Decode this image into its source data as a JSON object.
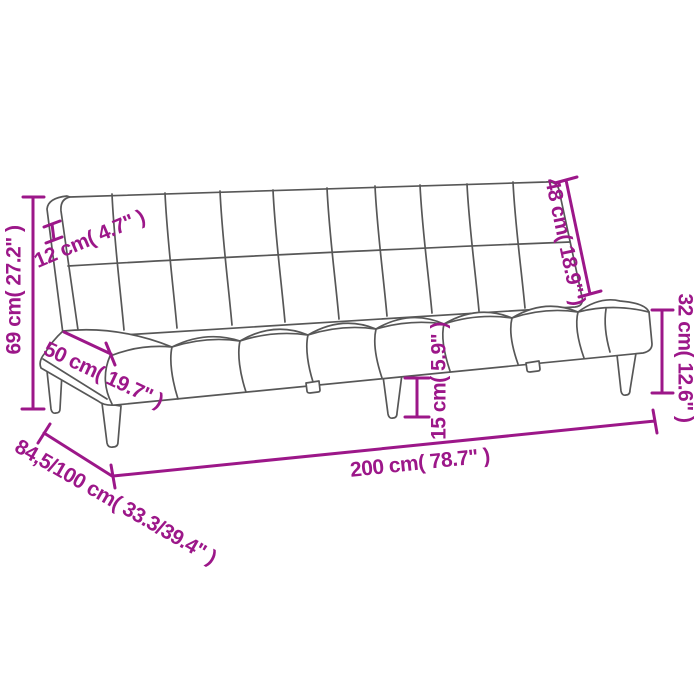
{
  "page": {
    "background_color": "#ffffff",
    "accent_color": "#9C1789",
    "line_color": "#575757"
  },
  "diagram": {
    "type": "product-dimension-diagram",
    "subject": "two-seater sofa bed line drawing with tufted backrest, tufted seat, tapered legs",
    "dimensions": [
      {
        "id": "overall-height",
        "label": "69 cm( 27.2\" )",
        "orientation": "vertical-left"
      },
      {
        "id": "backrest-thickness",
        "label": "12 cm( 4.7\" )",
        "orientation": "diagonal-up"
      },
      {
        "id": "backrest-length",
        "label": "48 cm( 18.9\" )",
        "orientation": "diagonal-down-right"
      },
      {
        "id": "seat-side-height",
        "label": "32 cm( 12.6\" )",
        "orientation": "vertical-right"
      },
      {
        "id": "seat-depth",
        "label": "50 cm( 19.7\" )",
        "orientation": "diagonal-down"
      },
      {
        "id": "leg-height",
        "label": "15 cm( 5.9\" )",
        "orientation": "vertical-middle"
      },
      {
        "id": "overall-width",
        "label": "200 cm( 78.7\" )",
        "orientation": "horizontal-bottom"
      },
      {
        "id": "overall-depth",
        "label": "84,5/100 cm( 33.3/39.4\" )",
        "orientation": "diagonal-bottom-left"
      }
    ]
  }
}
